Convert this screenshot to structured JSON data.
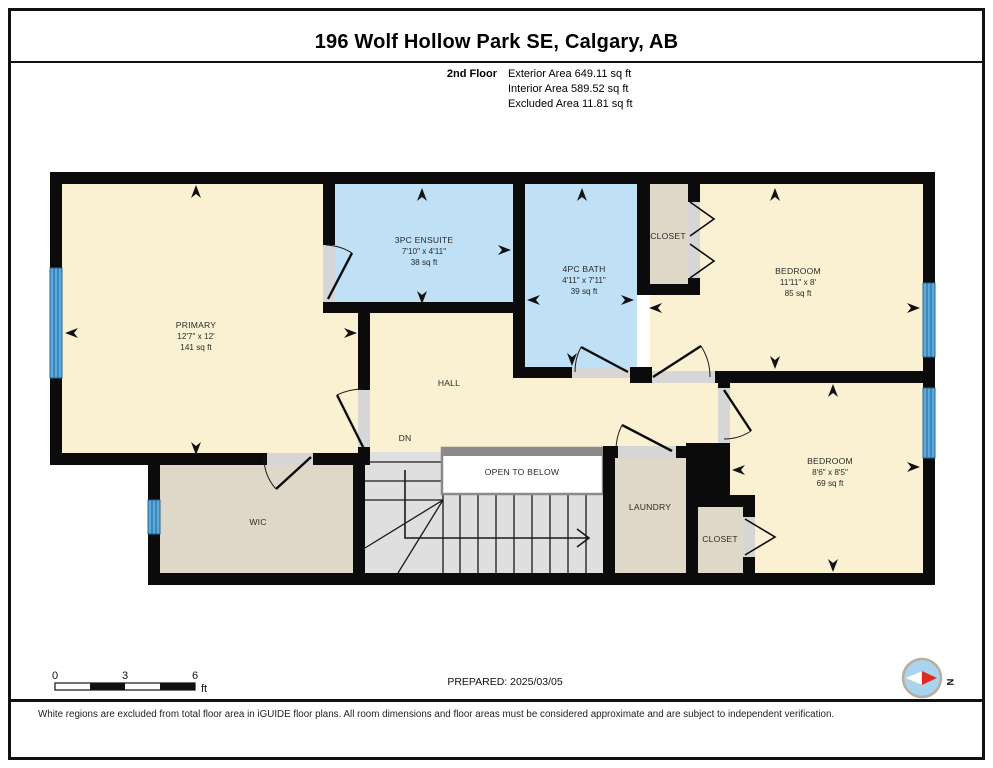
{
  "page": {
    "title": "196 Wolf Hollow Park SE, Calgary, AB",
    "floor_label": "2nd Floor",
    "areas": {
      "exterior": "Exterior Area 649.11 sq ft",
      "interior": "Interior Area 589.52 sq ft",
      "excluded": "Excluded Area 11.81 sq ft"
    },
    "prepared": "PREPARED: 2025/03/05",
    "disclaimer": "White regions are excluded from total floor area in iGUIDE floor plans. All room dimensions and floor areas must be considered approximate and are subject to independent verification.",
    "scale_bar": {
      "tick0": "0",
      "tick3": "3",
      "tick6": "6",
      "unit": "ft"
    },
    "compass_label": "N"
  },
  "rooms": {
    "primary": {
      "name": "PRIMARY",
      "dims": "12'7\" x 12'",
      "area": "141 sq ft"
    },
    "ensuite": {
      "name": "3PC ENSUITE",
      "dims": "7'10\" x 4'11\"",
      "area": "38 sq ft"
    },
    "bath": {
      "name": "4PC BATH",
      "dims": "4'11\" x 7'11\"",
      "area": "39 sq ft"
    },
    "closet_top": {
      "name": "CLOSET"
    },
    "bedroom_top": {
      "name": "BEDROOM",
      "dims": "11'11\" x 8'",
      "area": "85 sq ft"
    },
    "bedroom_bottom": {
      "name": "BEDROOM",
      "dims": "8'6\" x 8'5\"",
      "area": "69 sq ft"
    },
    "hall": {
      "name": "HALL"
    },
    "stairs": {
      "name": "DN"
    },
    "wic": {
      "name": "WIC"
    },
    "laundry": {
      "name": "LAUNDRY"
    },
    "closet_bottom": {
      "name": "CLOSET"
    },
    "open_to_below": {
      "name": "OPEN TO BELOW"
    }
  },
  "colors": {
    "room_cream": "#FAF0D2",
    "room_blue": "#BFE0F5",
    "room_tan": "#DFD8C9",
    "stairs_grey": "#DFDFDF",
    "wall_black": "#0B0B0B",
    "threshold_grey": "#D6D6D6",
    "window_blue": "#5BA9DD",
    "window_line": "#24648F",
    "open_below_border": "#8A8A8A",
    "compass_red": "#E02B20",
    "compass_face": "#A9D4EF"
  }
}
